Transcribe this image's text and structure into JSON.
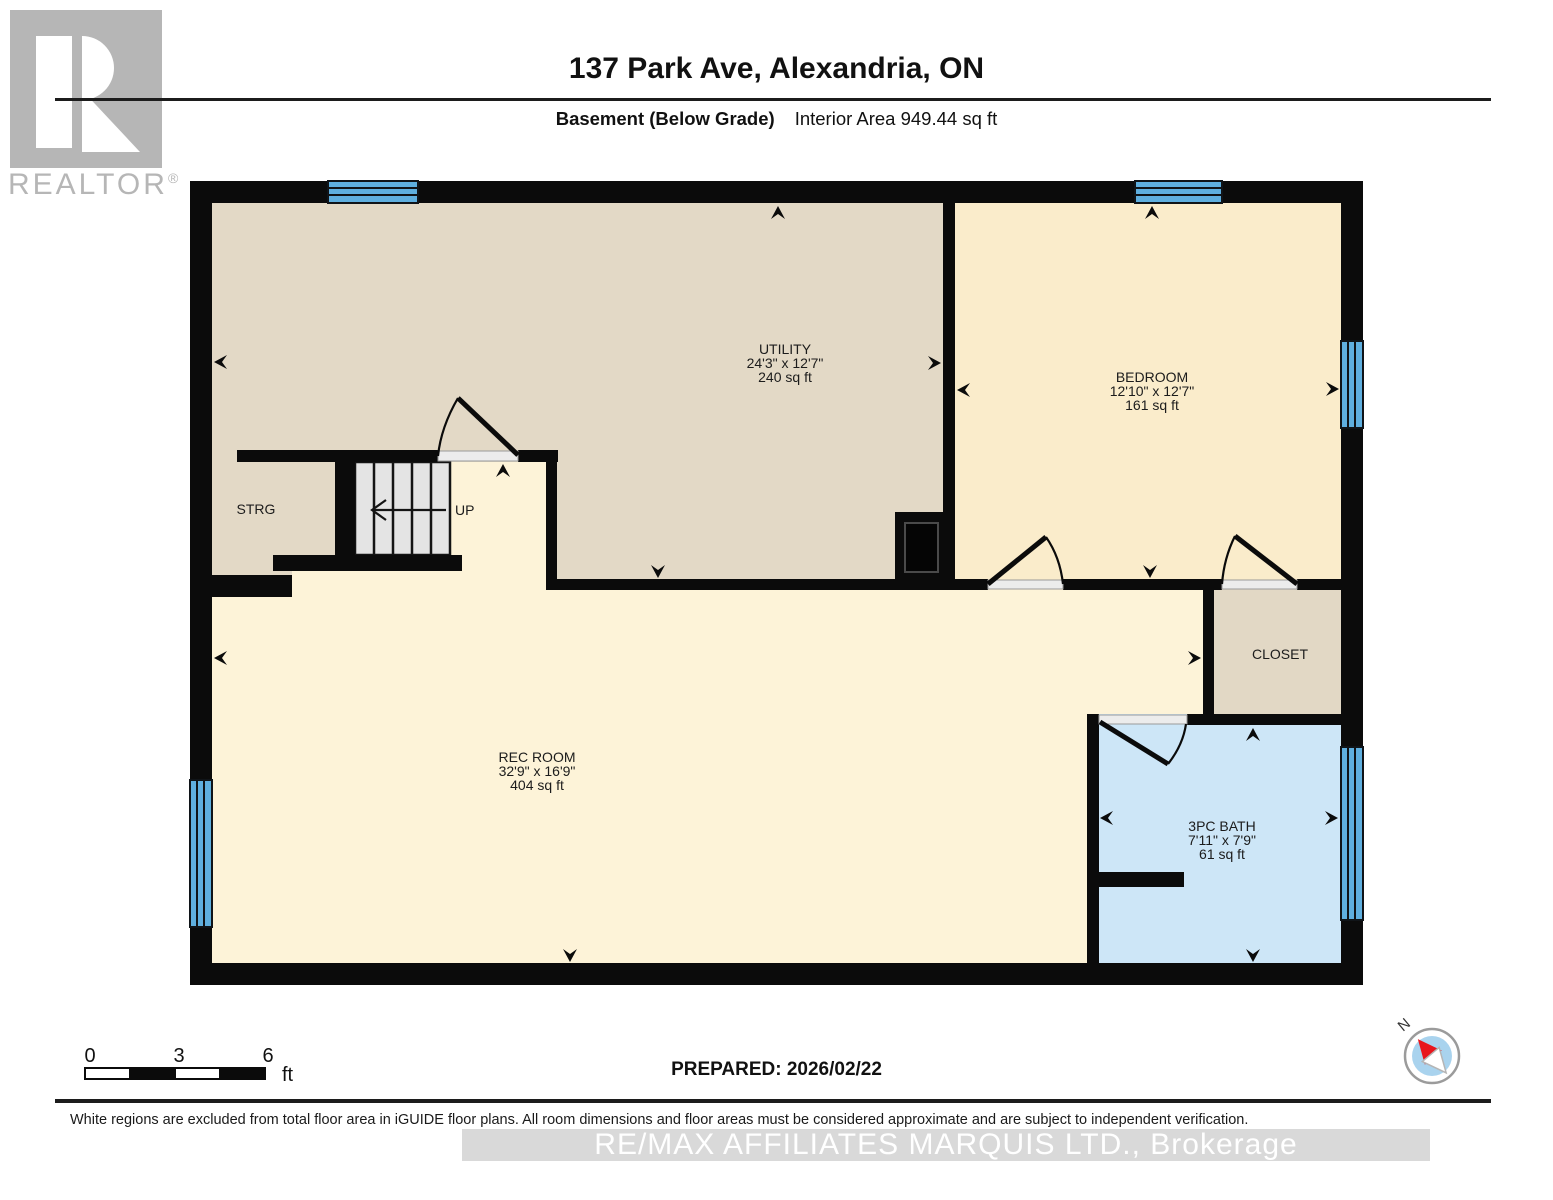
{
  "branding": {
    "logo_text": "REALTOR",
    "registered": "®"
  },
  "header": {
    "title": "137 Park Ave, Alexandria, ON",
    "floor_label": "Basement (Below Grade)",
    "area_label": "Interior Area 949.44 sq ft"
  },
  "rooms": {
    "utility": {
      "name": "UTILITY",
      "dims": "24'3\" x 12'7\"",
      "area": "240 sq ft"
    },
    "bedroom": {
      "name": "BEDROOM",
      "dims": "12'10\" x 12'7\"",
      "area": "161 sq ft"
    },
    "rec_room": {
      "name": "REC ROOM",
      "dims": "32'9\" x 16'9\"",
      "area": "404 sq ft"
    },
    "bath": {
      "name": "3PC BATH",
      "dims": "7'11\" x 7'9\"",
      "area": "61 sq ft"
    },
    "storage": {
      "name": "STRG"
    },
    "closet": {
      "name": "CLOSET"
    }
  },
  "stairs": {
    "label": "UP"
  },
  "scale_bar": {
    "tick_start": "0",
    "tick_mid": "3",
    "tick_end": "6",
    "unit": "ft"
  },
  "compass": {
    "north": "N"
  },
  "footer": {
    "prepared": "PREPARED: 2026/02/22",
    "disclaimer": "White regions are excluded from total floor area in iGUIDE floor plans. All room dimensions and floor areas must be considered approximate and are subject to independent verification.",
    "watermark": "RE/MAX AFFILIATES MARQUIS LTD., Brokerage"
  },
  "colors": {
    "wall": "#0b0b0b",
    "utility_floor": "#e3d9c6",
    "bedroom_floor": "#faeccb",
    "rec_floor": "#fdf3d8",
    "closet_floor": "#e2d8c5",
    "bath_floor": "#cde6f7",
    "window": "#5fafdf",
    "stairs": "#e4e4e4",
    "threshold": "#ececec",
    "compass_inner": "#a9d3ee",
    "compass_north": "#e8151d"
  }
}
